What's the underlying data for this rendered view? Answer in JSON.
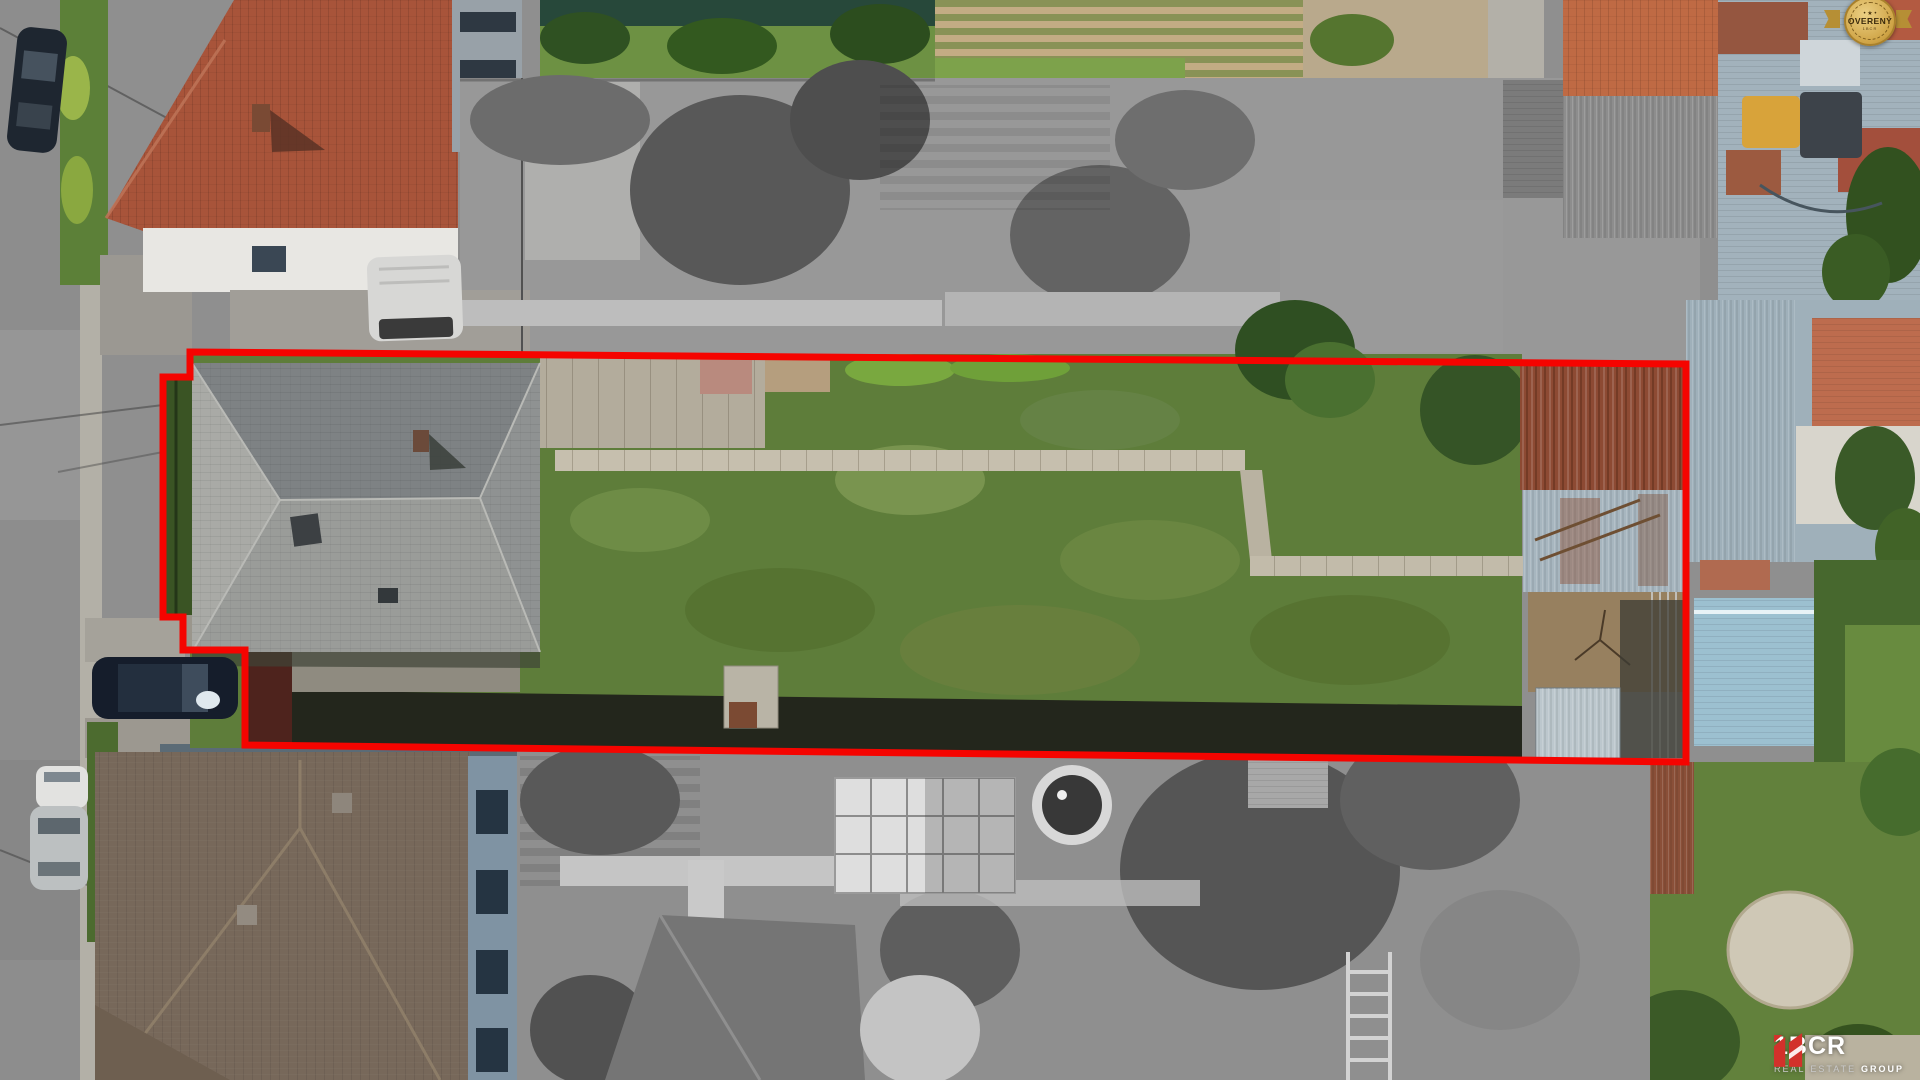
{
  "overlay": {
    "badge": {
      "label": "OVERENÝ",
      "sublabel": "1BCR",
      "stars": "• ★ •",
      "gold": "#d2a94f"
    },
    "logo": {
      "brand": "1BCR",
      "tagline": [
        "REAL",
        "ESTATE",
        "GROUP"
      ],
      "accent": "#d2312b"
    },
    "boundary": {
      "color": "#f50400",
      "stroke_width": "7",
      "points": "190,352 1686,364 1686,762 245,745 245,650 183,650 183,617 163,617 163,377 190,377"
    }
  }
}
